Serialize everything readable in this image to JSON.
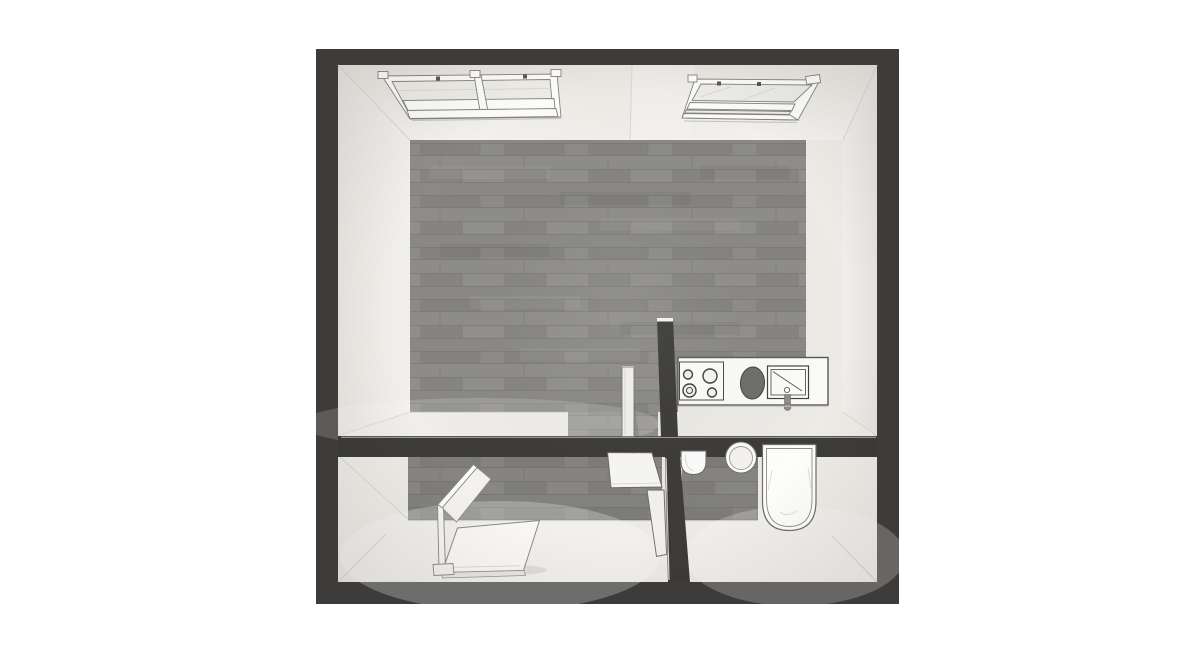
{
  "meta": {
    "type": "3d-floor-plan-top-down-render",
    "description": "Top-down 3D rendering of a small studio apartment floor plan",
    "visible_text": "none"
  },
  "palette": {
    "background": "#ffffff",
    "wall-dark": "#3d3c3a",
    "wall-cap": "#f6f5f2",
    "wall-face-top": "#e9e6e1",
    "wall-face-bright": "#f3f1ed",
    "floor-cream": "#edebe6",
    "floor-cream-bright": "#f7f6f3",
    "wood-base": "#8b8a87",
    "wood-seam": "#7b7a77",
    "glass": "#edebe6",
    "fixture-white": "#fbfbf9",
    "fixture-outline": "#5a5954",
    "frame-line": "#85847f",
    "basin-dark": "#6f6e6c",
    "metal-gray": "#8f8e8b",
    "seam-line": "#d9d6d0",
    "shadow-line": "#c5c2bc",
    "reflection": "#d8d5cf"
  },
  "plan": {
    "rooms": [
      {
        "name": "living-room",
        "floor": "gray wood planks",
        "features": [
          "double skylight window",
          "single skylight window",
          "open interior door",
          "partition wall stub"
        ]
      },
      {
        "name": "kitchen-nook",
        "floor": "gray wood planks",
        "fixtures": [
          "counter",
          "cooktop with 4 burners",
          "dark basin sink",
          "square sink with faucet"
        ]
      },
      {
        "name": "bedroom",
        "floor": "wood strip with light screed",
        "furniture": [
          "bed with standing headboard",
          "desk with side panel"
        ]
      },
      {
        "name": "bathroom",
        "floor": "wood strip with light screed",
        "fixtures": [
          "toilet",
          "round washbasin",
          "bathtub"
        ]
      }
    ],
    "walls": {
      "outer": "thick dark gray perimeter",
      "interior": [
        "horizontal wall separating top and bottom rooms",
        "kitchen partition stub",
        "bedroom-bathroom divider"
      ]
    }
  }
}
